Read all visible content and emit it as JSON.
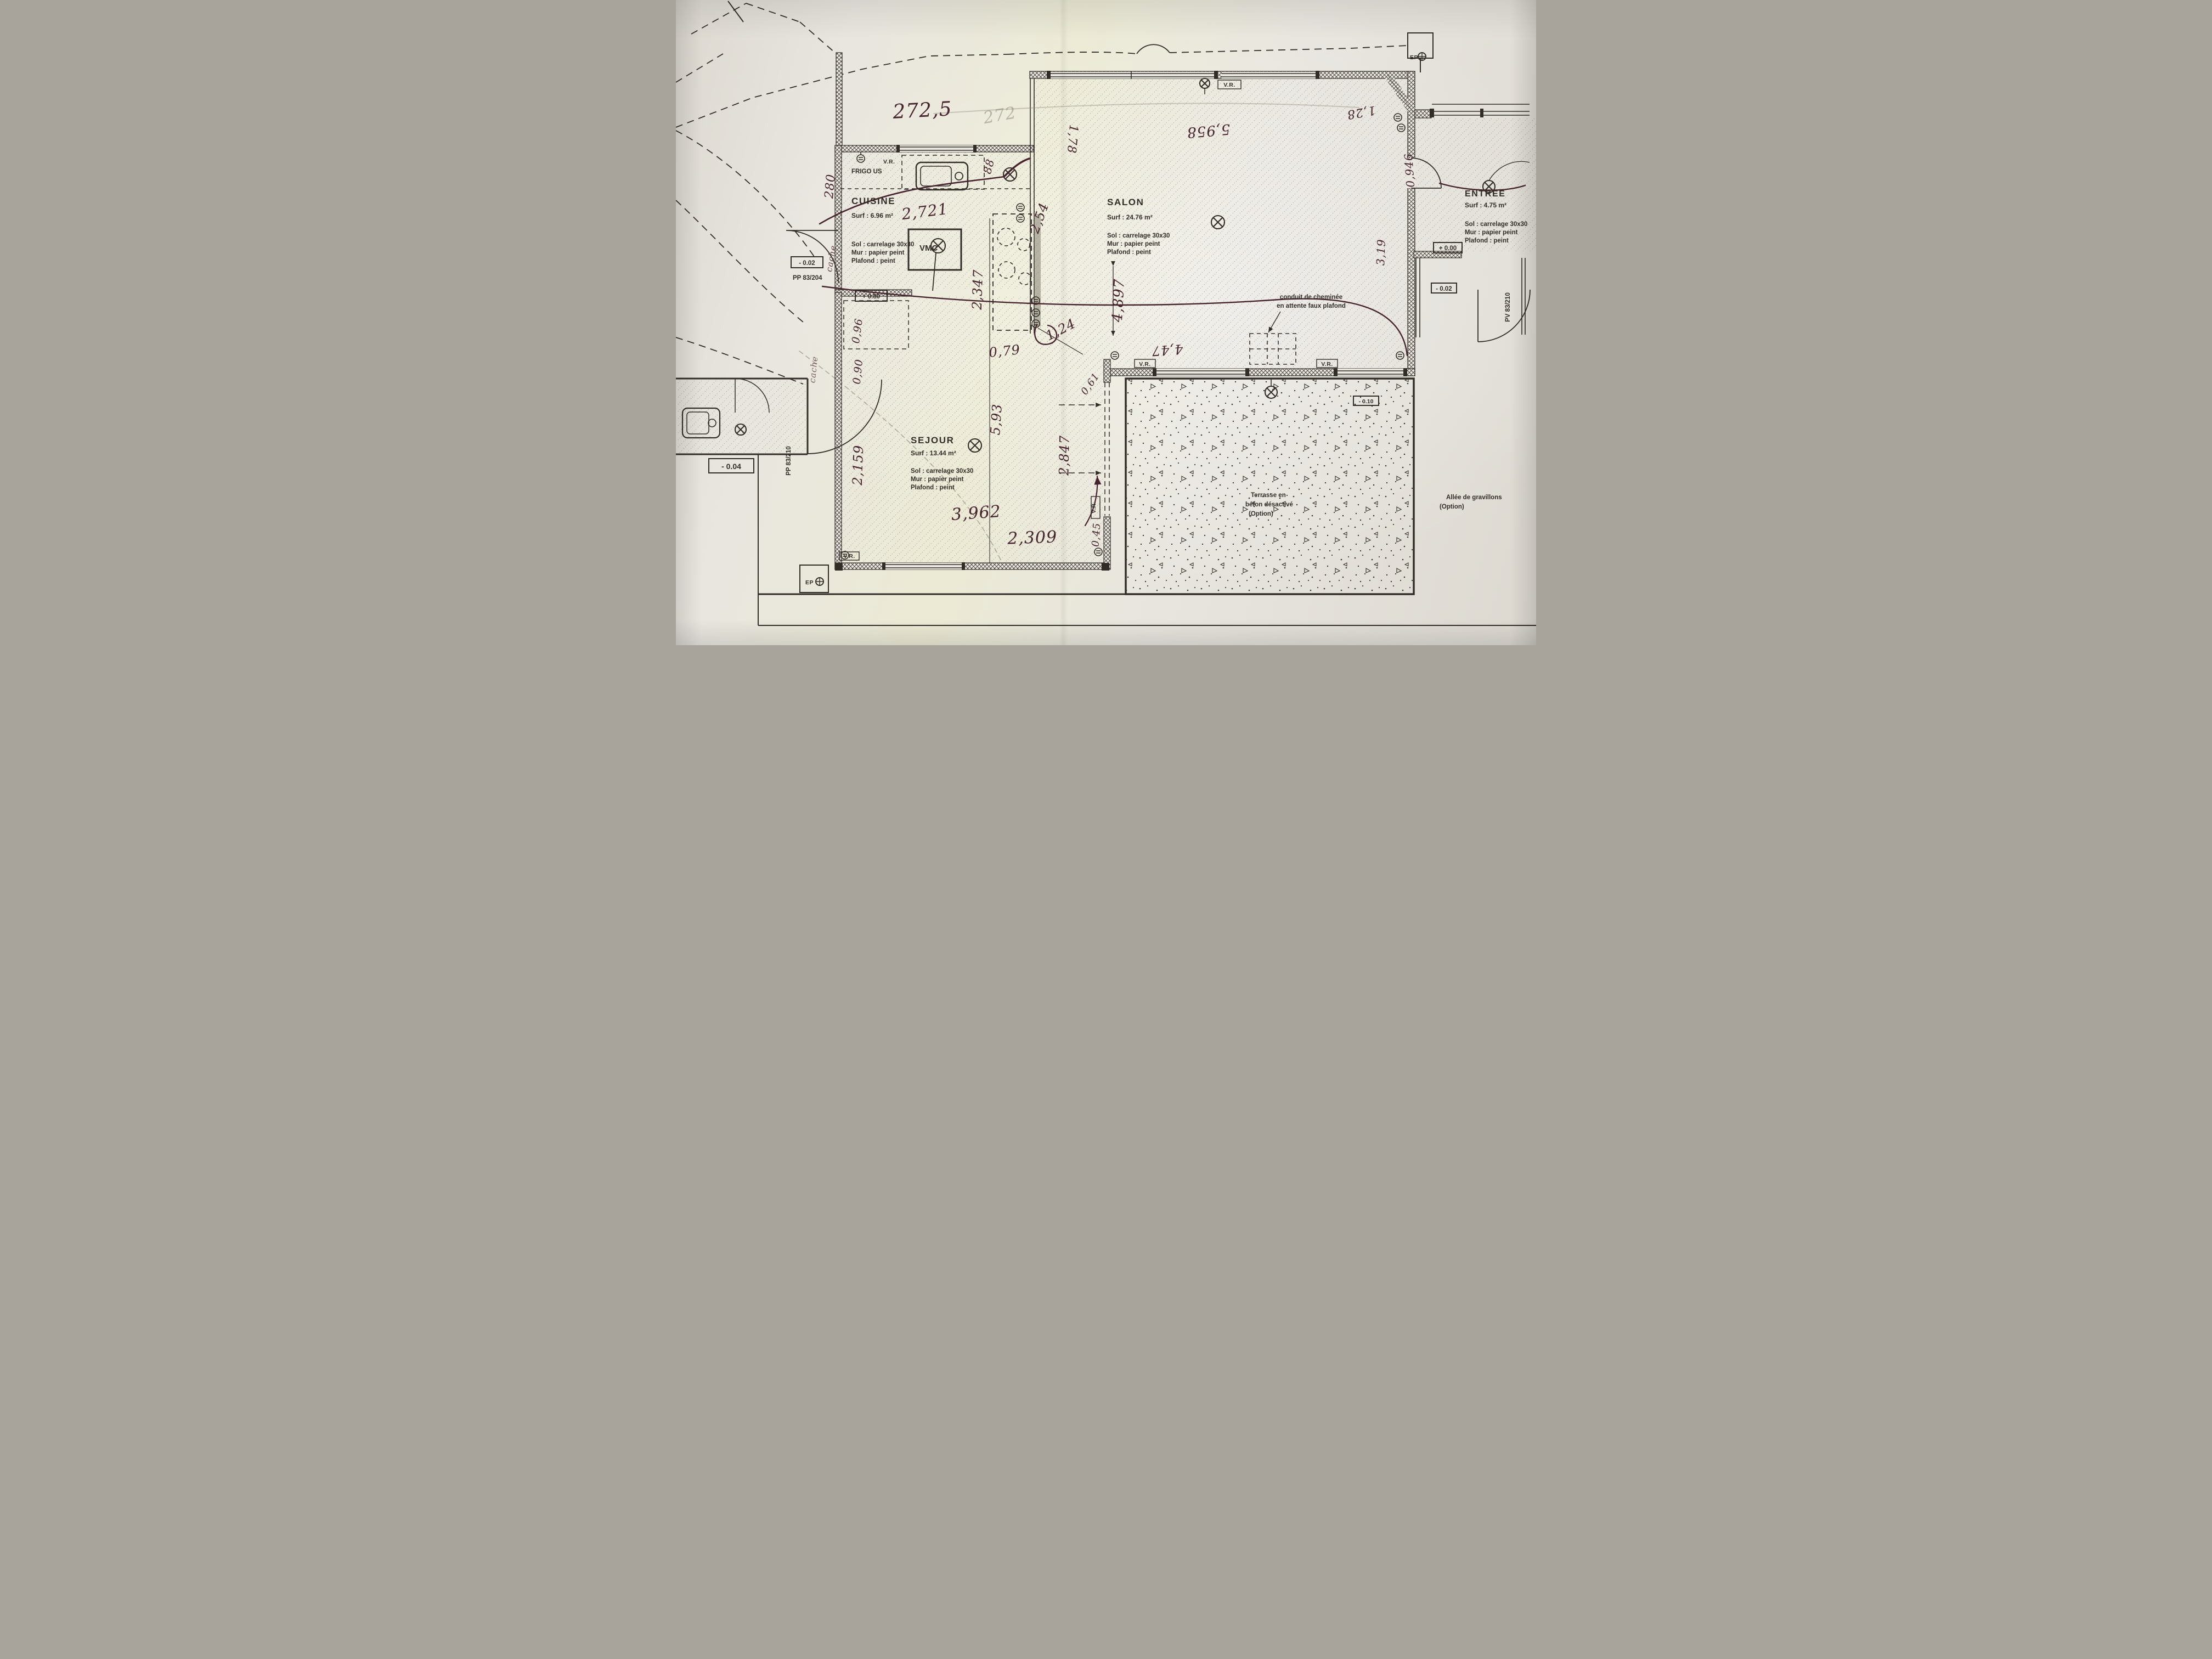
{
  "document": {
    "type": "hand-annotated architectural floor plan photo"
  },
  "colors": {
    "paper": "#e8e5df",
    "ink": "#332d28",
    "pen": "#46242e",
    "pencil": "#8e887b"
  },
  "rooms": {
    "cuisine": {
      "name": "CUISINE",
      "surf": "Surf : 6.96 m²",
      "sol": "Sol : carrelage 30x30",
      "mur": "Mur : papier peint",
      "plafond": "Plafond : peint"
    },
    "salon": {
      "name": "SALON",
      "surf": "Surf : 24.76 m²",
      "sol": "Sol : carrelage 30x30",
      "mur": "Mur : papier peint",
      "plafond": "Plafond : peint"
    },
    "sejour": {
      "name": "SEJOUR",
      "surf": "Surf : 13.44 m²",
      "sol": "Sol : carrelage 30x30",
      "mur": "Mur : papier peint",
      "plafond": "Plafond : peint"
    },
    "entree": {
      "name": "ENTREE",
      "surf": "Surf : 4.75 m²",
      "sol": "Sol : carrelage 30x30",
      "mur": "Mur : papier peint",
      "plafond": "Plafond : peint"
    }
  },
  "fixtures": {
    "frigo": "FRIGO US",
    "vmc": "VMC"
  },
  "window_labels": {
    "vr": "V.R."
  },
  "notes": {
    "conduit1": "conduit de cheminée",
    "conduit2": "en attente faux plafond",
    "terrasse1": "Terrasse en",
    "terrasse2": "béton désactivé",
    "terrasse3": "(Option)",
    "allee1": "Allée de gravillons",
    "allee2": "(Option)"
  },
  "levels": {
    "cuisine": "+ 0.80",
    "entree": "+ 0.00",
    "left": "- 0.02",
    "right": "- 0.02",
    "annex": "- 0.04",
    "terrace": "- 0.10"
  },
  "door_refs": {
    "pp204": "PP 83/204",
    "pp210": "PP 83/210",
    "pv210": "PV 83/210"
  },
  "site": {
    "ep": "EP"
  },
  "handwritten": {
    "top": "272,5",
    "top_faint": "272",
    "left280": "280",
    "k2721": "2,721",
    "d88": "88",
    "d254": "2,54",
    "d2347": "2,347",
    "d124": "1,24",
    "d079": "0,79",
    "d593": "5,93",
    "d2159": "2,159",
    "d096": "0,96",
    "d090": "0,90",
    "d3962": "3,962",
    "d2309": "2,309",
    "d2847": "2,847",
    "d045": "0,45",
    "d061": "0,61",
    "d5958": "5,958",
    "d128": "1,28",
    "d178": "1,78",
    "d4897": "4,897",
    "d447": "4,47",
    "d0946": "0,946",
    "d319": "3,19",
    "cache1": "cache",
    "cache2": "cache"
  }
}
